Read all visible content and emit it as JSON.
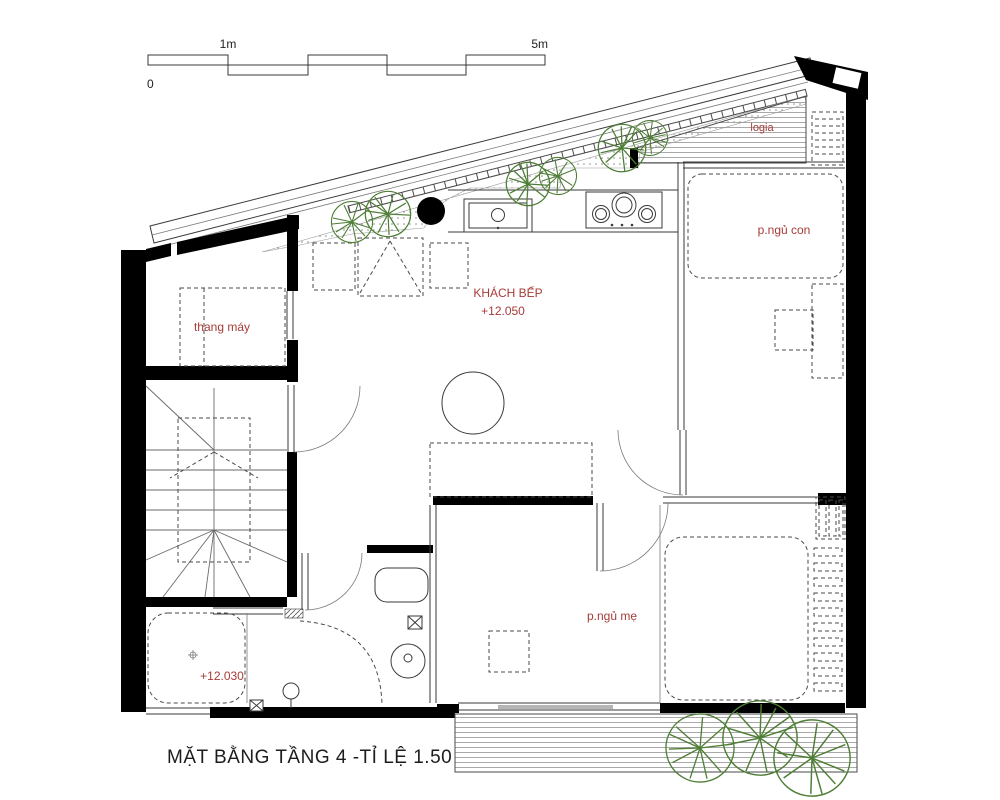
{
  "drawing": {
    "title": "MẶT BẰNG TẦNG 4 -TỈ LỆ 1.50",
    "scale_bar": {
      "zero": "0",
      "one_meter": "1m",
      "five_meters": "5m"
    },
    "rooms": {
      "logia": {
        "label": "logia"
      },
      "child_bedroom": {
        "label": "p.ngủ con"
      },
      "elevator": {
        "label": "thang máy"
      },
      "living_kitchen": {
        "label": "KHÁCH BẾP",
        "level": "+12.050"
      },
      "mother_bedroom": {
        "label": "p.ngủ mẹ"
      },
      "bathroom": {
        "level": "+12.030"
      }
    },
    "colors": {
      "label_red": "#a63c38",
      "tree_green": "#4e7e35",
      "wall_black": "#000000"
    }
  }
}
